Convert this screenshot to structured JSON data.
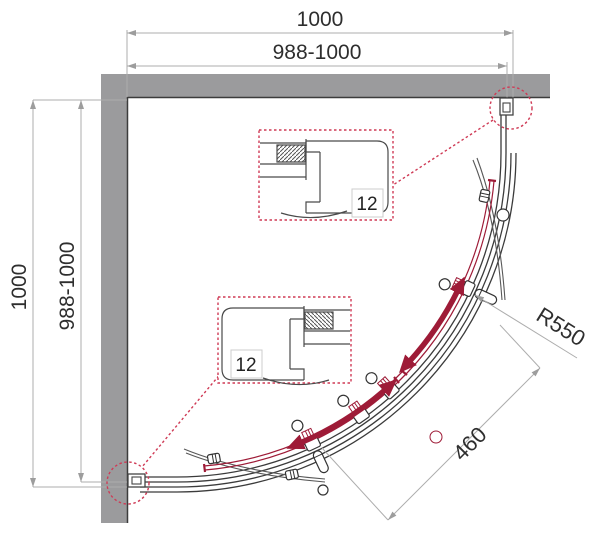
{
  "diagram": {
    "type": "technical-drawing",
    "subject": "quadrant-shower-enclosure-plan",
    "dimensions": {
      "top_width": "1000",
      "top_width_range": "988-1000",
      "side_height": "1000",
      "side_height_range": "988-1000",
      "radius": "R550",
      "door_opening": "460"
    },
    "details": {
      "top_label": "12",
      "bottom_label": "12"
    },
    "colors": {
      "wall": "#9b9b9d",
      "outline": "#3b3b3b",
      "door_accent": "#9e1b37",
      "callout_dashed": "#cf3a55",
      "dimension_line": "#adadad",
      "text": "#2e2e2e"
    }
  }
}
